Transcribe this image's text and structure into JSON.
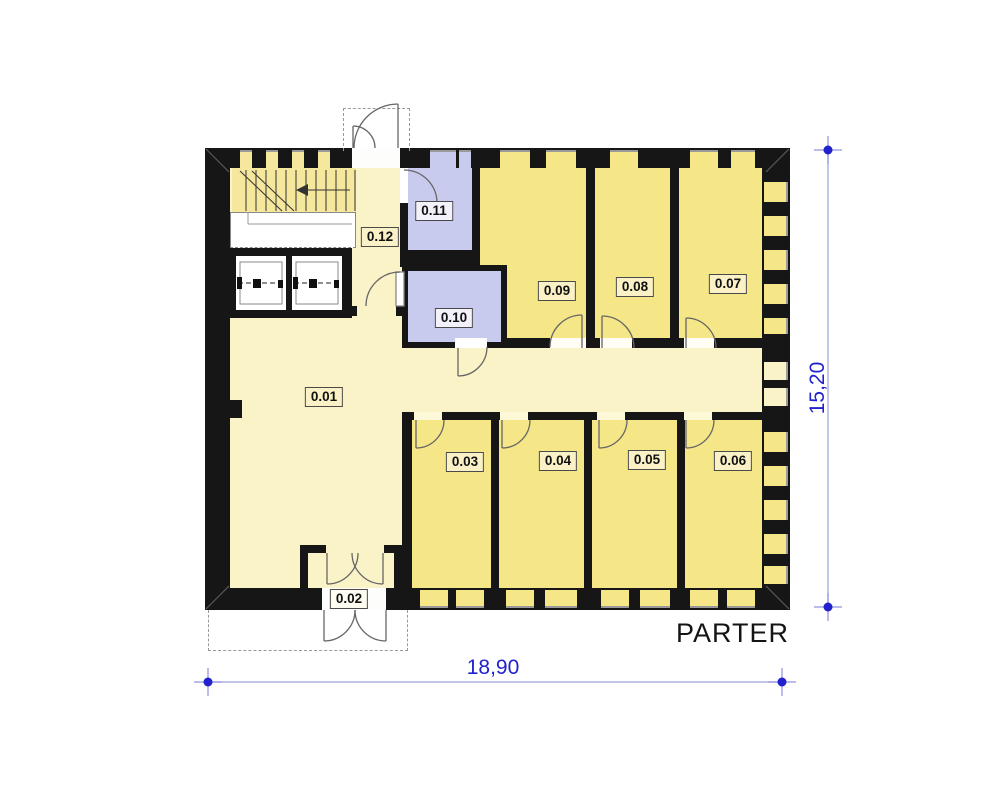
{
  "title": "PARTER",
  "floor_labels": {
    "r01": "0.01",
    "r02": "0.02",
    "r03": "0.03",
    "r04": "0.04",
    "r05": "0.05",
    "r06": "0.06",
    "r07": "0.07",
    "r08": "0.08",
    "r09": "0.09",
    "r10": "0.10",
    "r11": "0.11",
    "r12": "0.12"
  },
  "dimensions": {
    "width": "18,90",
    "height": "15,20"
  },
  "colors": {
    "room_yellow": "#F5E688",
    "corridor_cream": "#FAF3C8",
    "wet_room_lavender": "#C9CBEE",
    "stair_yellow": "#F5E79B",
    "wall_black": "#161616",
    "dimension_blue": "#2121CE"
  }
}
